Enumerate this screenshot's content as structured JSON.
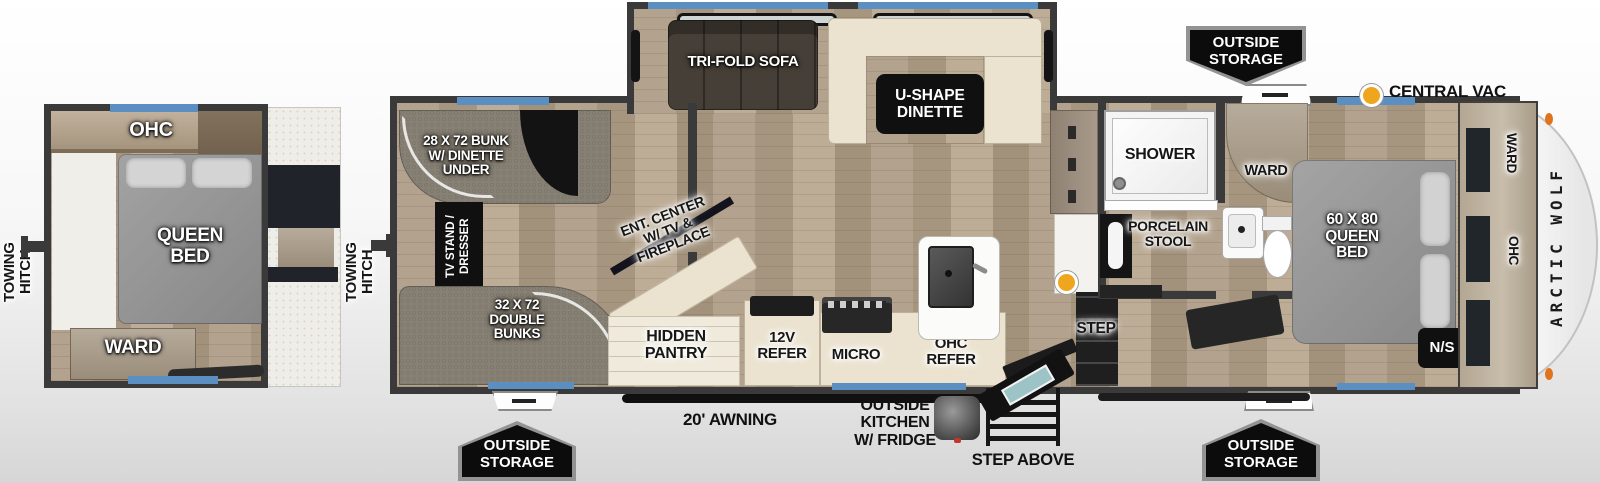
{
  "colors": {
    "window_blue": "#5b8fc2",
    "wall_gray": "#3a3a3a",
    "central_vac_dot": "#f0a51e",
    "marker_orange": "#e0731c"
  },
  "mini_plan": {
    "towing_hitch": "TOWING\nHITCH",
    "ohc": "OHC",
    "queen_bed": "QUEEN\nBED",
    "ward": "WARD"
  },
  "main_plan": {
    "towing_hitch": "TOWING\nHITCH",
    "bunk_room": {
      "bunk_top": "28 X 72 BUNK\nW/ DINETTE\nUNDER",
      "tv_stand": "TV STAND /\nDRESSER",
      "double_bunks": "32 X 72\nDOUBLE\nBUNKS"
    },
    "slide_out": {
      "sofa": "TRI-FOLD SOFA",
      "dinette": "U-SHAPE\nDINETTE"
    },
    "kitchen": {
      "ent_center": "ENT. CENTER\nW/ TV &\nFIREPLACE",
      "hidden_pantry": "HIDDEN\nPANTRY",
      "refer_12v": "12V\nREFER",
      "micro": "MICRO",
      "ohc_refer": "OHC\nREFER"
    },
    "entry": {
      "step": "STEP"
    },
    "bath": {
      "shower": "SHOWER",
      "porcelain_stool": "PORCELAIN\nSTOOL",
      "ward": "WARD"
    },
    "bedroom": {
      "queen_bed": "60 X 80\nQUEEN\nBED",
      "night_shade": "N/S",
      "ward": "WARD",
      "ohc": "OHC"
    },
    "central_vac": "CENTRAL VAC",
    "brand": "ARCTIC WOLF"
  },
  "exterior": {
    "outside_storage": "OUTSIDE\nSTORAGE",
    "awning": "20' AWNING",
    "outside_kitchen": "OUTSIDE\nKITCHEN\nW/ FRIDGE",
    "step_above": "STEP ABOVE"
  }
}
